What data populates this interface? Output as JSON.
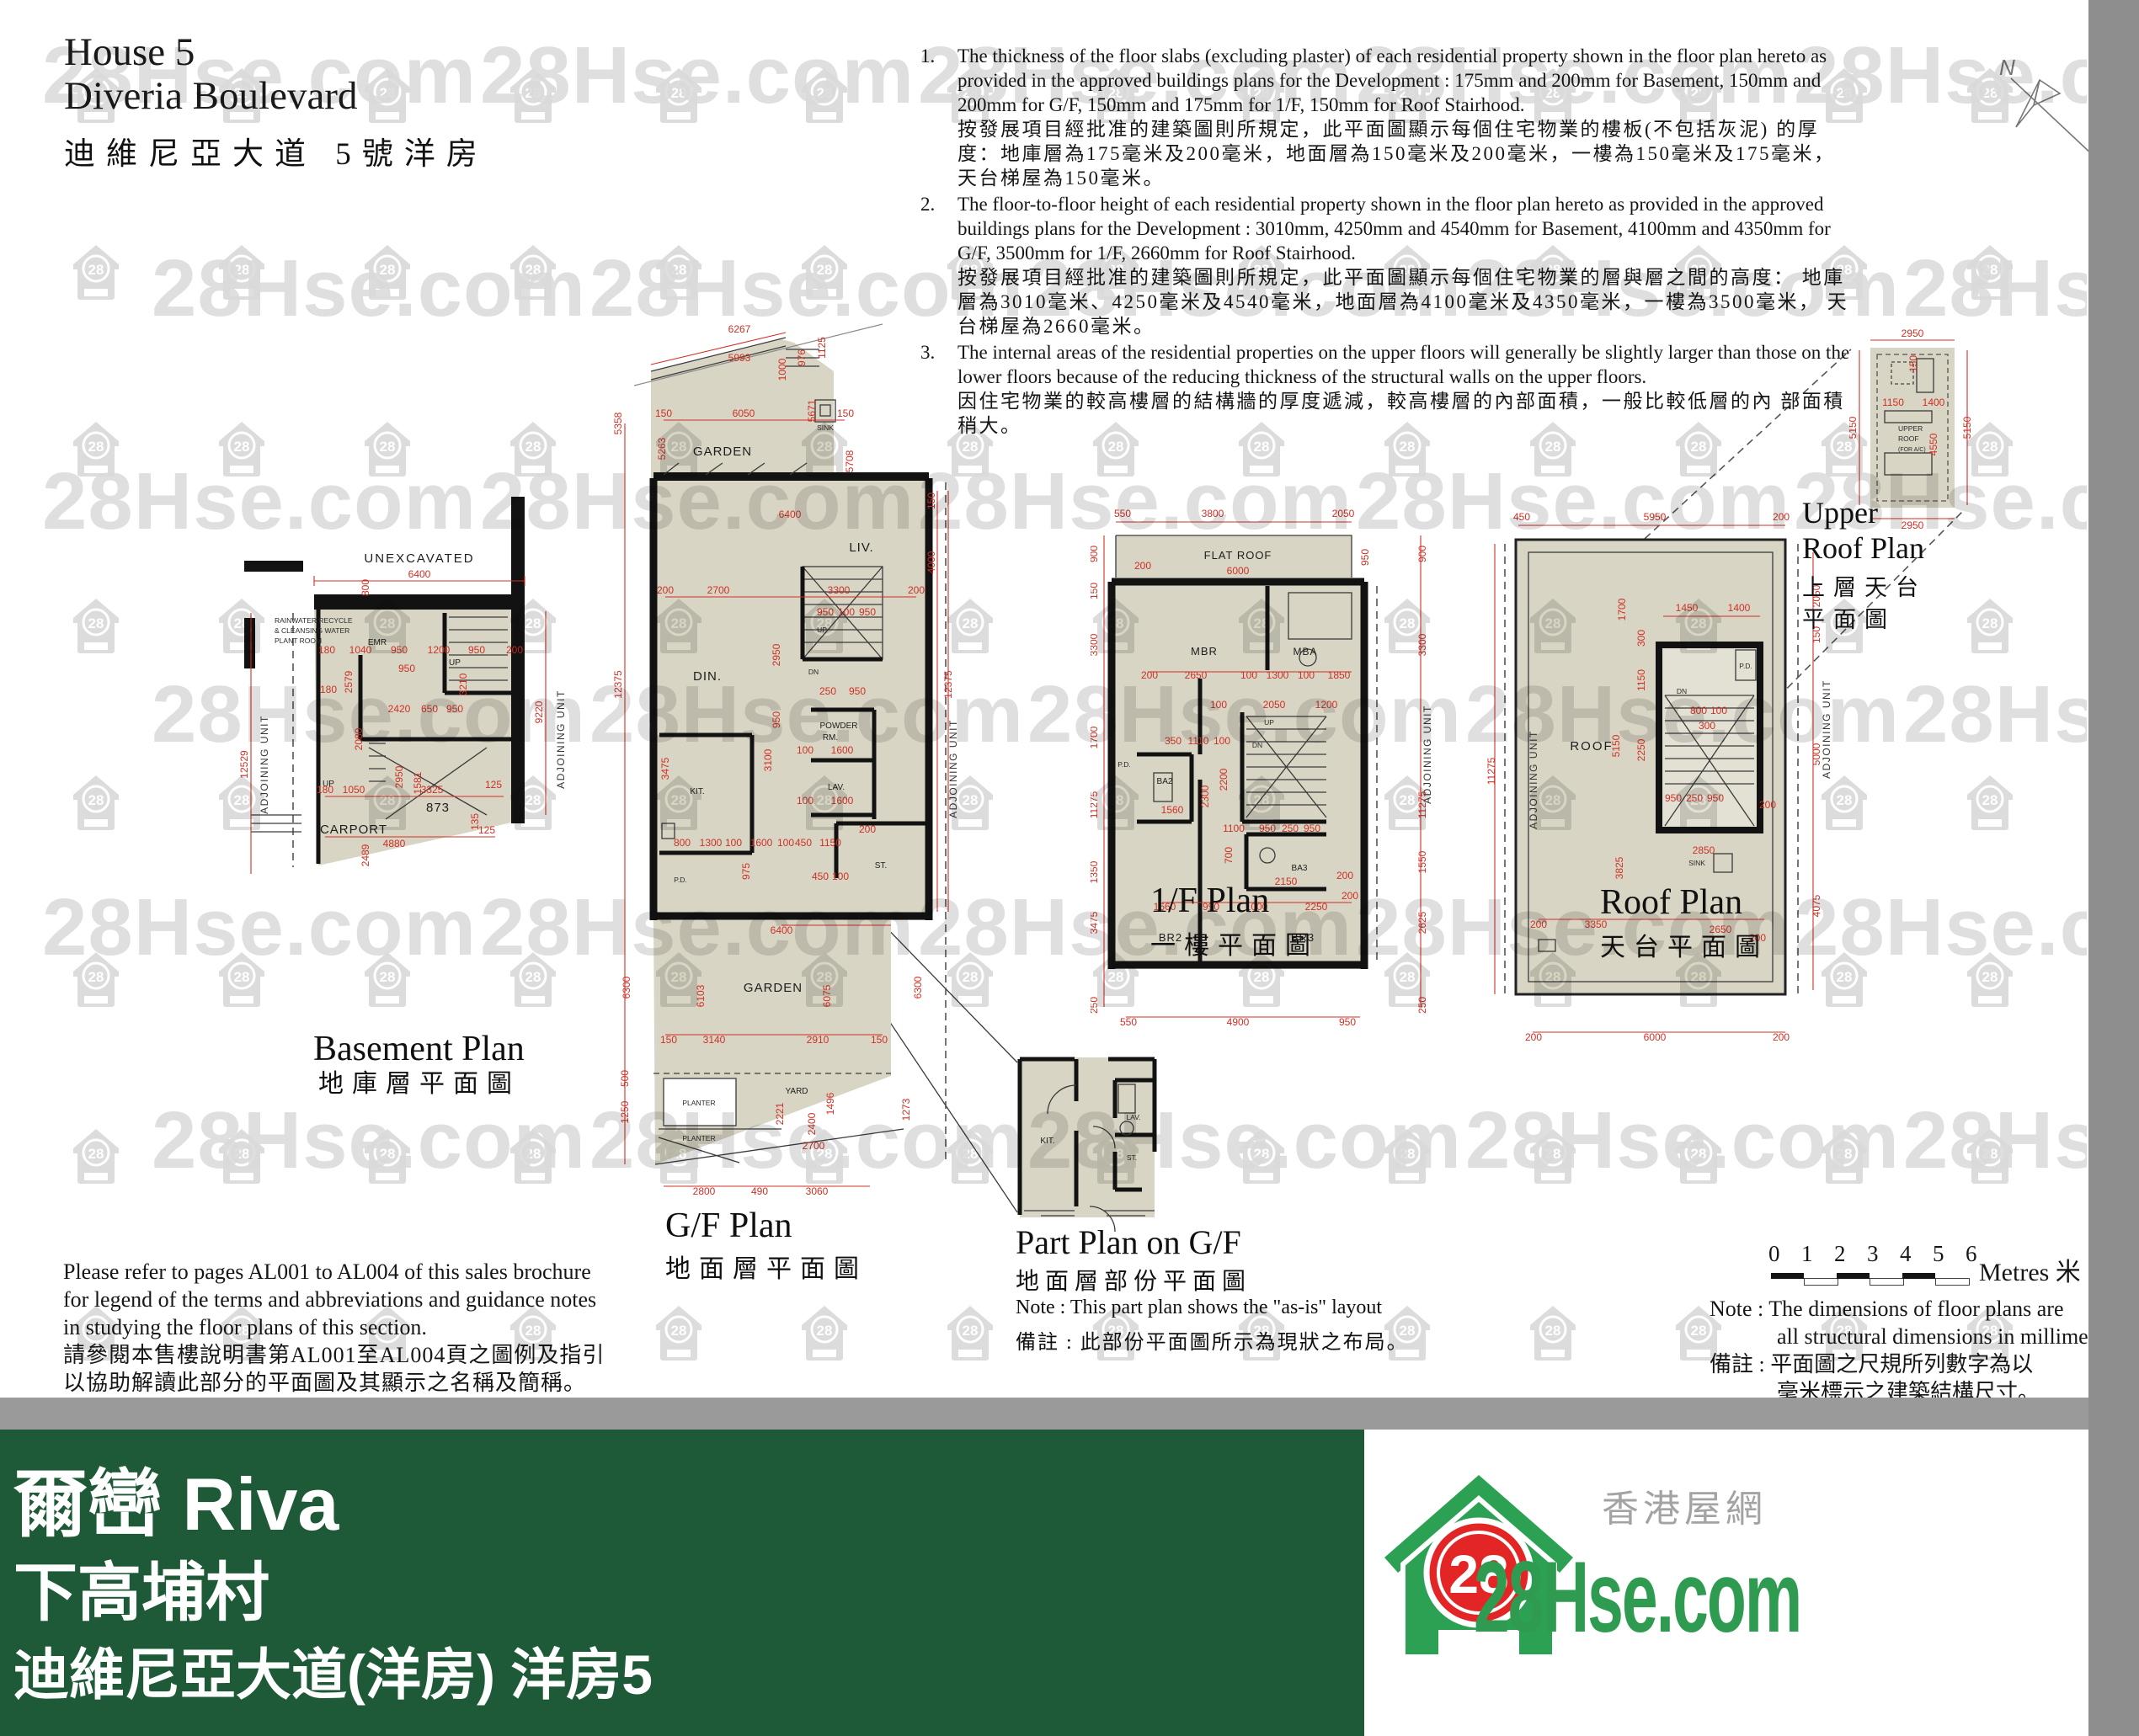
{
  "header": {
    "title_line1": "House 5",
    "title_line2": "Diveria Boulevard",
    "title_zh": "迪維尼亞大道 5號洋房"
  },
  "notes": [
    {
      "num": "1.",
      "en": "The thickness of the floor slabs (excluding plaster) of each residential property shown in the floor plan hereto as provided in the approved buildings plans for the Development : 175mm and 200mm for Basement, 150mm and 200mm for G/F, 150mm and 175mm for 1/F, 150mm for Roof Stairhood.",
      "zh": "按發展項目經批准的建築圖則所規定，此平面圖顯示每個住宅物業的樓板(不包括灰泥) 的厚度：地庫層為175毫米及200毫米，地面層為150毫米及200毫米，一樓為150毫米及175毫米， 天台梯屋為150毫米。"
    },
    {
      "num": "2.",
      "en": "The floor-to-floor height of each residential property shown in the floor plan hereto as provided in the approved buildings plans for the Development : 3010mm, 4250mm and 4540mm for Basement, 4100mm and 4350mm for G/F, 3500mm for 1/F, 2660mm for Roof Stairhood.",
      "zh": "按發展項目經批准的建築圖則所規定，此平面圖顯示每個住宅物業的層與層之間的高度： 地庫層為3010毫米、4250毫米及4540毫米，地面層為4100毫米及4350毫米，一樓為3500毫米， 天台梯屋為2660毫米。"
    },
    {
      "num": "3.",
      "en": "The internal areas of the residential properties on the upper floors will generally be slightly larger than those on the lower floors because of the reducing thickness of the structural walls on the upper floors.",
      "zh": "因住宅物業的較高樓層的結構牆的厚度遞減，較高樓層的內部面積，一般比較低層的內 部面積稍大。"
    }
  ],
  "plans": {
    "basement": {
      "title": "Basement Plan",
      "title_zh": "地庫層平面圖",
      "labels": {
        "unexcavated": "UNEXCAVATED",
        "plant1": "RAINWATER RECYCLE",
        "plant2": "& CLEANSING WATER",
        "plant3": "PLANT ROOM",
        "emr": "EMR",
        "up": "UP",
        "carport": "CARPORT",
        "n873": "873",
        "adj": "ADJOINING UNIT"
      },
      "dims": [
        "6400",
        "800",
        "180",
        "1040",
        "950",
        "1200",
        "950",
        "200",
        "2579",
        "950",
        "180",
        "2420",
        "650",
        "950",
        "3210",
        "2080",
        "2950",
        "12529",
        "9220",
        "180",
        "1050",
        "3325",
        "125",
        "1581",
        "4880",
        "125",
        "135",
        "2489"
      ]
    },
    "gf": {
      "title": "G/F Plan",
      "title_zh": "地面層平面圖",
      "labels": {
        "garden": "GARDEN",
        "sink": "SINK",
        "liv": "LIV.",
        "din": "DIN.",
        "up": "UP",
        "dn": "DN",
        "powder1": "POWDER",
        "powder2": "RM.",
        "lav": "LAV.",
        "kit": "KIT.",
        "pd": "P.D.",
        "st": "ST.",
        "yard": "YARD",
        "planter": "PLANTER",
        "adj": "ADJOINING UNIT"
      },
      "dims": [
        "6267",
        "5993",
        "1000",
        "976",
        "1125",
        "150",
        "6050",
        "5671",
        "150",
        "5263",
        "5358",
        "5708",
        "6400",
        "150",
        "4000",
        "200",
        "2700",
        "3300",
        "200",
        "950",
        "100",
        "950",
        "2950",
        "950",
        "12375",
        "12375",
        "250",
        "950",
        "1600",
        "100",
        "1600",
        "100",
        "3100",
        "3475",
        "800",
        "1300",
        "100",
        "1600",
        "100",
        "450",
        "1150",
        "200",
        "975",
        "450",
        "100",
        "6400",
        "6103",
        "6075",
        "6300",
        "6300",
        "150",
        "3140",
        "2910",
        "150",
        "500",
        "1250",
        "2221",
        "1496",
        "2400",
        "1273",
        "2700",
        "2800",
        "490",
        "3060"
      ]
    },
    "ff": {
      "title": "1/F Plan",
      "title_zh": "一樓平面圖",
      "labels": {
        "flatroof": "FLAT ROOF",
        "mbr": "MBR",
        "mba": "MBA",
        "ba2": "BA2",
        "ba3": "BA3",
        "br2": "BR2",
        "br3": "BR3",
        "pd": "P.D.",
        "up": "UP",
        "dn": "DN",
        "adj": "ADJOINING UNIT"
      },
      "dims": [
        "550",
        "3800",
        "2050",
        "200",
        "6000",
        "950",
        "900",
        "900",
        "150",
        "3300",
        "3300",
        "200",
        "2650",
        "100",
        "1300",
        "100",
        "1850",
        "2050",
        "1200",
        "100",
        "350",
        "1110",
        "100",
        "1700",
        "11275",
        "11275",
        "2200",
        "1100",
        "950",
        "250",
        "950",
        "1560",
        "2300",
        "1350",
        "2150",
        "200",
        "700",
        "1550",
        "1660",
        "990",
        "1000",
        "2250",
        "200",
        "3475",
        "2625",
        "550",
        "4900",
        "950",
        "250",
        "250"
      ]
    },
    "roof": {
      "title": "Roof Plan",
      "title_zh": "天台平面圖",
      "labels": {
        "roof": "ROOF",
        "sink": "SINK",
        "dn": "DN",
        "pd": "P.D.",
        "adj": "ADJOINING UNIT"
      },
      "dims": [
        "450",
        "5950",
        "200",
        "1450",
        "1400",
        "2050",
        "150",
        "1700",
        "300",
        "1150",
        "5150",
        "2250",
        "5000",
        "800",
        "100",
        "300",
        "950",
        "250",
        "950",
        "200",
        "11275",
        "2850",
        "3825",
        "200",
        "3350",
        "2650",
        "200",
        "4075",
        "200",
        "6000",
        "200"
      ]
    },
    "ur": {
      "title_l1": "Upper",
      "title_l2": "Roof Plan",
      "title_zh_l1": "上層天台",
      "title_zh_l2": "平面圖",
      "labels": {
        "l1": "UPPER",
        "l2": "ROOF",
        "l3": "(FOR A/C)"
      },
      "dims": [
        "2950",
        "150",
        "1150",
        "1400",
        "4550",
        "5150",
        "5150",
        "2950"
      ]
    },
    "part": {
      "title": "Part Plan on G/F",
      "title_zh": "地面層部份平面圖",
      "note_en": "Note : This part plan shows the \"as-is\" layout",
      "note_zh": "備註 : 此部份平面圖所示為現狀之布局。",
      "labels": {
        "kit": "KIT.",
        "lav": "LAV.",
        "st": "ST."
      }
    }
  },
  "legend": {
    "en": "Please refer to pages AL001 to AL004 of this sales brochure for legend of the terms and abbreviations and guidance notes in studying the floor plans of this section.",
    "zh": "請參閱本售樓說明書第AL001至AL004頁之圖例及指引 以協助解讀此部分的平面圖及其顯示之名稱及簡稱。"
  },
  "scale_bar": {
    "ticks": [
      "0",
      "1",
      "2",
      "3",
      "4",
      "5",
      "6"
    ],
    "unit": "Metres 米"
  },
  "dim_note": {
    "en1": "Note : The dimensions of floor plans are",
    "en2": "all structural dimensions in millimeter.",
    "zh1": "備註 : 平面圖之尺規所列數字為以",
    "zh2": "毫米標示之建築結構尺寸。"
  },
  "footer": {
    "dev_name": "爾巒 Riva",
    "village": "下高埔村",
    "unit_line": "迪維尼亞大道(洋房) 洋房5"
  },
  "logo": {
    "badge": "28",
    "site": "28Hse.com",
    "site_zh": "香港屋網"
  },
  "watermark": {
    "text": "28Hse.com",
    "badge": "28"
  },
  "compass": {
    "label": "N"
  }
}
